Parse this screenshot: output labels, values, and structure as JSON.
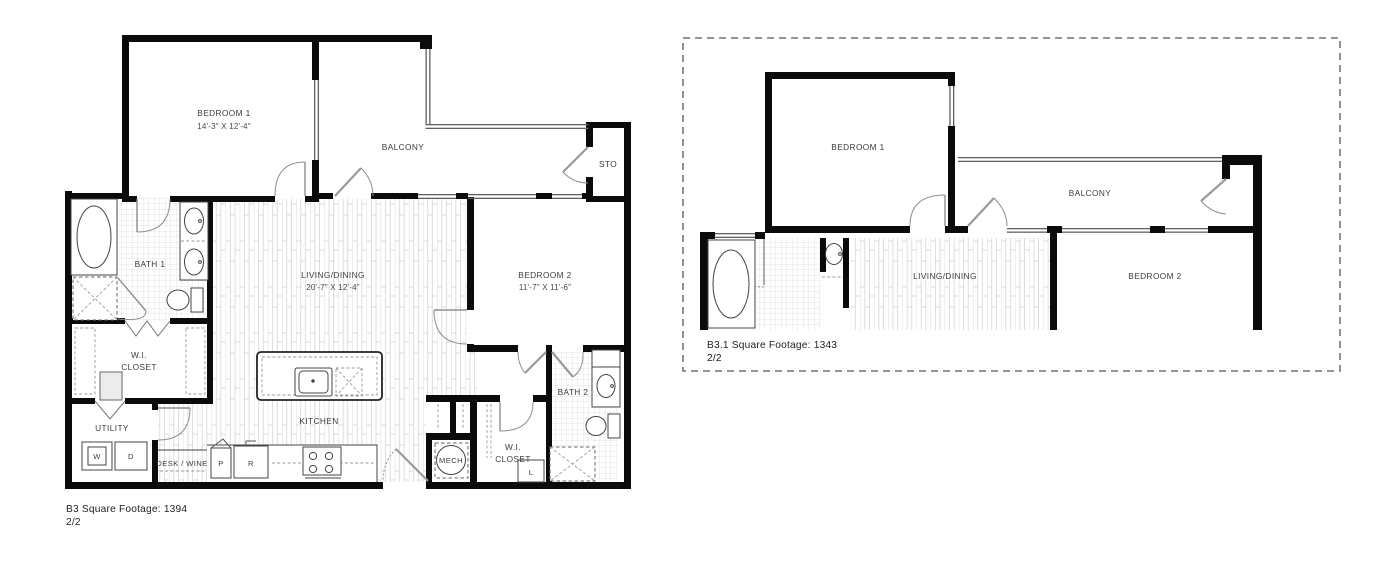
{
  "canvas": {
    "background": "#ffffff",
    "wall_color": "#0b0b0b",
    "accent_gray": "#8f8f8f"
  },
  "plans": [
    {
      "name": "B3",
      "footer": {
        "line1": "B3 Square Footage: 1394",
        "line2": "2/2"
      },
      "labels": {
        "bedroom1": "BEDROOM 1",
        "bedroom1_dims": "14'-3\" X 12'-4\"",
        "balcony": "BALCONY",
        "storage": "STO",
        "bath1": "BATH 1",
        "living_dining": "LIVING/DINING",
        "living_dining_dims": "20'-7\" X 12'-4\"",
        "bedroom2": "BEDROOM 2",
        "bedroom2_dims": "11'-7\" X 11'-6\"",
        "wi_closet_line1": "W.I.",
        "wi_closet_line2": "CLOSET",
        "utility": "UTILITY",
        "washer": "W",
        "dryer": "D",
        "desk_wine": "DESK / WINE",
        "pantry": "P",
        "refrigerator": "R",
        "kitchen": "KITCHEN",
        "mech": "MECH",
        "wi_closet2_line1": "W.I.",
        "wi_closet2_line2": "CLOSET",
        "linen": "L",
        "bath2": "BATH 2"
      }
    },
    {
      "name": "B3.1",
      "footer": {
        "line1": "B3.1 Square Footage: 1343",
        "line2": "2/2"
      },
      "labels": {
        "bedroom1": "BEDROOM 1",
        "balcony": "BALCONY",
        "living_dining": "LIVING/DINING",
        "bedroom2": "BEDROOM 2"
      }
    }
  ]
}
